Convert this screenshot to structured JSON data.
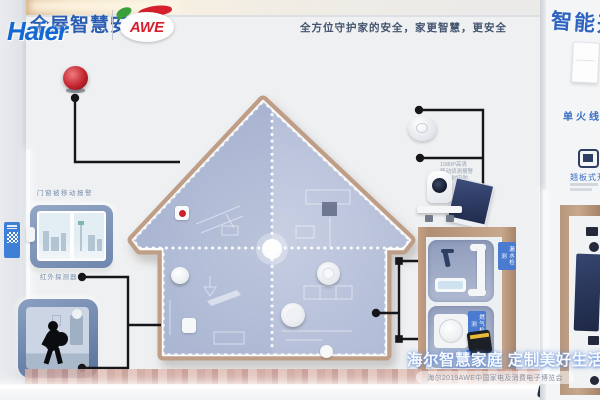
{
  "header": {
    "brand": "Haier",
    "title": "全屋智慧安防",
    "awe": "AWE",
    "slogan": "全方位守护家的安全，家更智慧，更安全"
  },
  "left": {
    "door_sensor_label": "门窗被移动报警",
    "infrared_label": "红外探测器"
  },
  "right_devices": {
    "camera_specs": [
      "1080P高清",
      "移动侦测报警",
      "24小时安防"
    ],
    "leak_tag": "漏水检测",
    "gas_tag": "燃气检测"
  },
  "switch_panel": {
    "banner": "智能开关",
    "wire_label": "单火线",
    "type_label": "翘板式开关"
  },
  "watermark": {
    "main": "海尔智慧家庭 定制美好生活",
    "sub": "海尔2019AWE中国家电及消费电子博览会"
  },
  "colors": {
    "haier_blue": "#1468d2",
    "title_blue": "#2a5cb0",
    "awe_red": "#d61f2c",
    "wood": "#bf9e88",
    "house_fill": "#b4bfd9",
    "connector_black": "#15151a",
    "tag_blue": "#4a7bd0"
  }
}
